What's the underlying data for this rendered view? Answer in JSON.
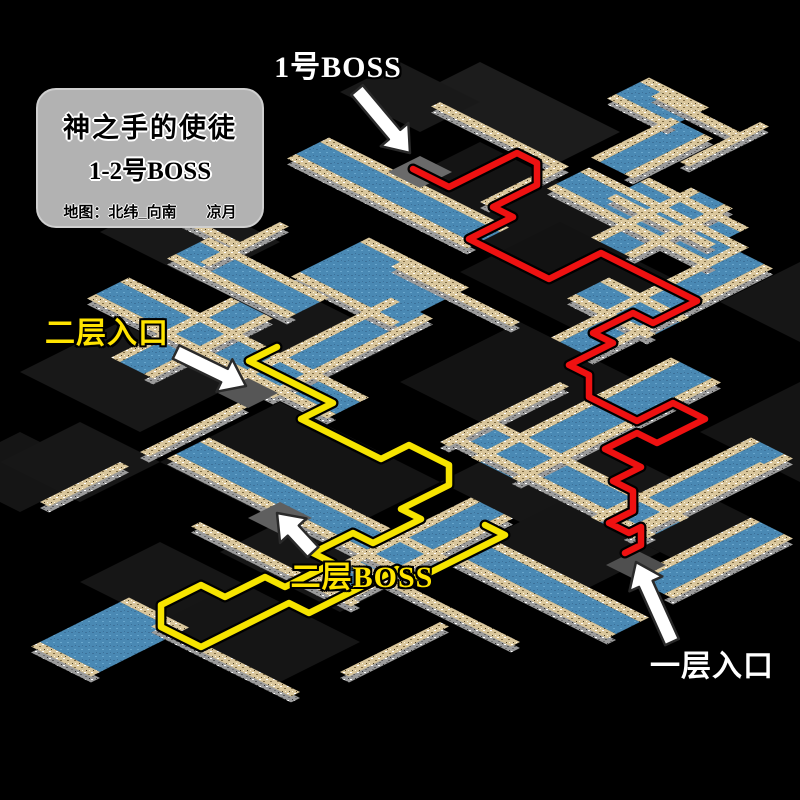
{
  "info_box": {
    "title": "神之手的使徒",
    "line2": "1-2号BOSS",
    "credit": "地图：北纬_向南　　凉月"
  },
  "labels": [
    {
      "id": "boss1",
      "text": "1号BOSS",
      "x": 338,
      "y": 64,
      "color": "#ffffff"
    },
    {
      "id": "entrance2",
      "text": "二层入口",
      "x": 107,
      "y": 330,
      "color": "#ffe400"
    },
    {
      "id": "boss2",
      "text": "二层BOSS",
      "x": 362,
      "y": 574,
      "color": "#ffe400"
    },
    {
      "id": "entrance1",
      "text": "一层入口",
      "x": 712,
      "y": 663,
      "color": "#ffffff"
    }
  ],
  "arrows": [
    {
      "name": "boss1-arrow",
      "from": [
        357,
        90
      ],
      "to": [
        410,
        153
      ]
    },
    {
      "name": "entrance2-arrow",
      "from": [
        176,
        352
      ],
      "to": [
        246,
        386
      ]
    },
    {
      "name": "boss2-arrow",
      "from": [
        313,
        552
      ],
      "to": [
        277,
        513
      ]
    },
    {
      "name": "entrance1-arrow",
      "from": [
        672,
        642
      ],
      "to": [
        636,
        562
      ]
    }
  ],
  "routes": {
    "red": {
      "color": "#ee1111",
      "points": [
        [
          413,
          169
        ],
        [
          449,
          187
        ],
        [
          517,
          153
        ],
        [
          537,
          163
        ],
        [
          537,
          185
        ],
        [
          493,
          207
        ],
        [
          513,
          217
        ],
        [
          469,
          239
        ],
        [
          549,
          279
        ],
        [
          601,
          253
        ],
        [
          697,
          301
        ],
        [
          653,
          323
        ],
        [
          633,
          313
        ],
        [
          593,
          333
        ],
        [
          613,
          343
        ],
        [
          569,
          365
        ],
        [
          589,
          375
        ],
        [
          589,
          397
        ],
        [
          637,
          421
        ],
        [
          673,
          403
        ],
        [
          705,
          419
        ],
        [
          657,
          443
        ],
        [
          637,
          433
        ],
        [
          605,
          449
        ],
        [
          641,
          467
        ],
        [
          613,
          481
        ],
        [
          633,
          491
        ],
        [
          633,
          511
        ],
        [
          609,
          523
        ],
        [
          629,
          533
        ],
        [
          641,
          527
        ],
        [
          641,
          545
        ],
        [
          625,
          553
        ]
      ]
    },
    "yellow": {
      "color": "#f6e400",
      "points": [
        [
          277,
          347
        ],
        [
          249,
          361
        ],
        [
          333,
          403
        ],
        [
          301,
          419
        ],
        [
          381,
          459
        ],
        [
          409,
          445
        ],
        [
          449,
          465
        ],
        [
          449,
          485
        ],
        [
          401,
          509
        ],
        [
          421,
          519
        ],
        [
          373,
          543
        ],
        [
          353,
          533
        ],
        [
          313,
          553
        ],
        [
          333,
          563
        ],
        [
          285,
          587
        ],
        [
          265,
          577
        ],
        [
          225,
          597
        ],
        [
          201,
          585
        ],
        [
          161,
          605
        ],
        [
          161,
          627
        ],
        [
          201,
          647
        ],
        [
          289,
          603
        ],
        [
          309,
          613
        ],
        [
          397,
          569
        ],
        [
          417,
          579
        ],
        [
          505,
          535
        ],
        [
          485,
          525
        ]
      ]
    }
  },
  "map": {
    "colors": {
      "background": "#000000",
      "water": "#4a89b4",
      "water_dark": "#3c719a",
      "water_light": "#68a6cd",
      "wall_top": "#d9c69c",
      "wall_top_dark": "#7e6b44",
      "wall_side": "#9b9b9b",
      "route_red": "#ee1111",
      "route_yellow": "#f6e400",
      "info_box_bg": "#b2b2b2",
      "label_yellow": "#ffe400",
      "label_white": "#ffffff",
      "arrow_fill": "#ffffff"
    },
    "floors": [
      [
        4,
        0,
        7,
        3,
        "#1c1c1c"
      ],
      [
        2,
        2,
        4,
        3,
        "#191919"
      ],
      [
        8,
        4,
        8,
        5,
        "#141414"
      ],
      [
        14,
        6,
        6,
        5,
        "#121212"
      ],
      [
        3,
        14,
        5,
        4,
        "#181818"
      ],
      [
        10,
        16,
        6,
        5,
        "#161616"
      ],
      [
        18,
        12,
        6,
        6,
        "#131313"
      ],
      [
        8,
        22,
        6,
        5,
        "#181818"
      ],
      [
        16,
        22,
        8,
        6,
        "#141414"
      ],
      [
        24,
        16,
        6,
        6,
        "#161616"
      ],
      [
        22,
        26,
        6,
        5,
        "#171717"
      ],
      [
        28,
        20,
        5,
        5,
        "#151515"
      ],
      [
        22,
        2,
        5,
        4,
        "#161616"
      ],
      [
        28,
        8,
        5,
        5,
        "#141414"
      ],
      [
        11,
        30,
        4,
        4,
        "#151515"
      ],
      [
        20,
        32,
        5,
        4,
        "#161616"
      ],
      [
        12,
        28,
        4,
        4,
        "#171717"
      ],
      [
        30,
        16,
        4,
        4,
        "#141414"
      ],
      [
        24,
        32,
        6,
        4,
        "#151515"
      ]
    ],
    "water": [
      [
        "se",
        4,
        8,
        9,
        1.2
      ],
      [
        "se",
        12,
        3,
        8,
        1.2
      ],
      [
        "sw",
        20,
        3,
        4,
        1.2
      ],
      [
        "se",
        10,
        12,
        5,
        3
      ],
      [
        "se",
        6,
        20,
        12,
        1.2
      ],
      [
        "sw",
        14,
        14,
        8,
        1.2
      ],
      [
        "sw",
        24,
        10,
        10,
        1.6
      ],
      [
        "se",
        16,
        26,
        12,
        1.2
      ],
      [
        "se",
        22,
        18,
        10,
        1.2
      ],
      [
        "sw",
        30,
        12,
        8,
        1.2
      ],
      [
        "sw",
        20,
        6,
        6,
        1.2
      ],
      [
        "se",
        6,
        16,
        6,
        1.2
      ],
      [
        "se",
        14,
        2,
        5,
        1.2
      ],
      [
        "sw",
        16,
        1,
        5,
        1.2
      ],
      [
        "se",
        22,
        36,
        3,
        4
      ],
      [
        "sw",
        26,
        22,
        8,
        1.2
      ],
      [
        "se",
        28,
        24,
        8,
        1.2
      ],
      [
        "sw",
        34,
        16,
        6,
        1.2
      ],
      [
        "se",
        9,
        -3,
        3,
        1.2
      ],
      [
        "sw",
        12,
        -2,
        4,
        1.2
      ],
      [
        "se",
        18,
        8,
        4,
        1.2
      ],
      [
        "sw",
        10,
        18,
        6,
        1.2
      ]
    ],
    "walls": [
      [
        "se",
        5,
        3,
        6
      ],
      [
        "sw",
        11,
        3,
        4
      ],
      [
        "se",
        2,
        15,
        5
      ],
      [
        "sw",
        7,
        13,
        4
      ],
      [
        "se",
        20,
        30,
        8
      ],
      [
        "se",
        26,
        28,
        8
      ],
      [
        "sw",
        31,
        13,
        6
      ],
      [
        "se",
        24,
        36,
        7
      ],
      [
        "sw",
        31,
        29,
        5
      ],
      [
        "sw",
        15,
        23,
        5
      ],
      [
        "sw",
        22,
        14,
        6
      ],
      [
        "se",
        12,
        12,
        6
      ],
      [
        "se",
        10,
        -3,
        4
      ],
      [
        "sw",
        14,
        -4,
        4
      ],
      [
        "sw",
        15,
        29,
        4
      ]
    ],
    "stairs": [
      [
        7.2,
        6.2,
        1.6,
        1.6,
        "#6a6a6a"
      ],
      [
        14,
        21.6,
        1.5,
        1.5,
        "#565656"
      ],
      [
        21,
        27,
        1.6,
        1.6,
        "#5f5f5f"
      ],
      [
        32.3,
        20.5,
        1.5,
        1.5,
        "#4f4f4f"
      ]
    ]
  }
}
